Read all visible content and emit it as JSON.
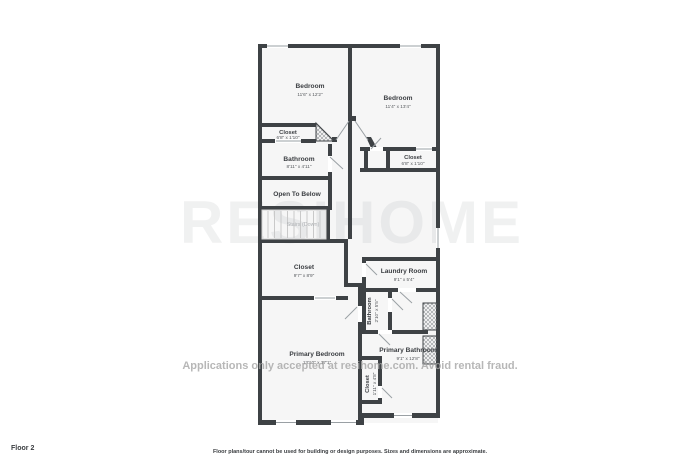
{
  "floor_plan": {
    "floor_label": "Floor 2",
    "disclaimer": "Floor plans/tour cannot be used for building or design purposes. Sizes and dimensions are approximate.",
    "watermark_large": "RESIHOME",
    "watermark_line": "Applications only accepted at resihome.com. Avoid rental fraud.",
    "colors": {
      "walls": "#3e4245",
      "door_lines": "#9aa0a4",
      "hatch": "#8f9396"
    },
    "rooms": [
      {
        "name": "Bedroom",
        "dims": "11'6\" x 12'2\""
      },
      {
        "name": "Bedroom",
        "dims": "11'4\" x 13'4\""
      },
      {
        "name": "Closet",
        "dims": "6'8\" x 1'10\""
      },
      {
        "name": "Bathroom",
        "dims": "8'11\" x 4'11\""
      },
      {
        "name": "Closet",
        "dims": "6'8\" x 1'10\""
      },
      {
        "name": "Open To Below",
        "dims": ""
      },
      {
        "name": "Stairs (Down)",
        "dims": ""
      },
      {
        "name": "Closet",
        "dims": "9'7\" x 8'9\""
      },
      {
        "name": "Laundry Room",
        "dims": "9'1\" x 5'4\""
      },
      {
        "name": "Bathroom",
        "dims": "2'10\" x 5'5\""
      },
      {
        "name": "Primary Bedroom",
        "dims": "13'10\" x 17'1\""
      },
      {
        "name": "Primary Bathroom",
        "dims": "9'1\" x 12'8\""
      },
      {
        "name": "Closet",
        "dims": "1'11\" x 4'8\""
      }
    ]
  }
}
